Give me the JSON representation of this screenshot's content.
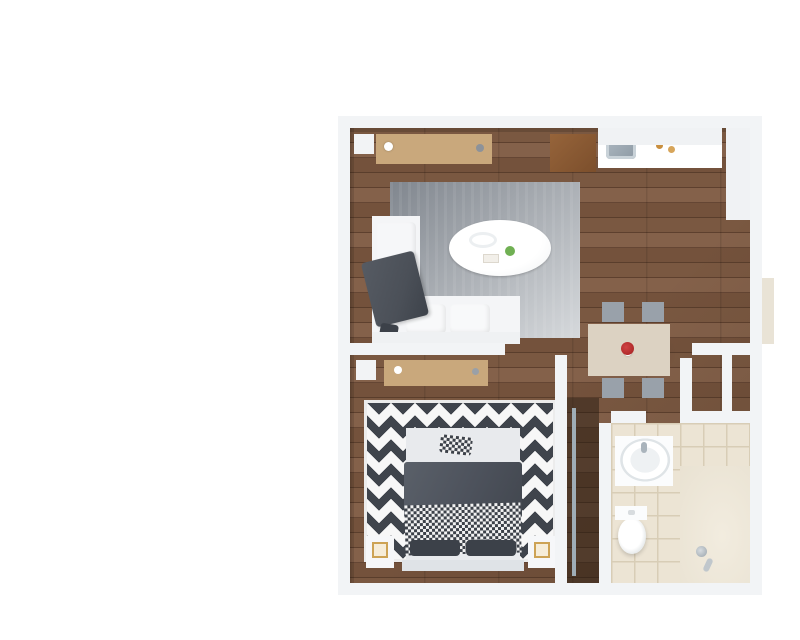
{
  "view": {
    "style": "3d-isometric-floorplan-render",
    "background": "#ffffff",
    "unit_type": "one-bedroom-apartment"
  },
  "palette": {
    "bg": "#ffffff",
    "walltop": "#f2f4f6",
    "wallin": "#e8ebee",
    "wallin2": "#e2e5e9",
    "wallpart": "#e6e9ec",
    "wallext": "#cdd3da",
    "wallext2": "#d6dbe1",
    "slab": "#c4cad1",
    "wood1": "#7a5841",
    "wood2": "#5e402e",
    "wood3": "#84614a",
    "wood4": "#654634",
    "tile": "#ece4d4",
    "tileline": "#d8cdb6",
    "shower": "#f2ecdf",
    "shade": "rgba(30,20,10,0.16)",
    "rug1": "#80868e",
    "rug2": "#d6d9dc",
    "chev": "#3f444c",
    "sofa": "#f4f5f7",
    "sofaside": "#e2e5e9",
    "sofadark": "#d4d8dd",
    "throw": "#4b5058",
    "duvet": "#4d525c",
    "mattress": "#e8eaed",
    "headboard": "#dfe3e7",
    "pillow": "#3c4149",
    "woodtop": "#c9a87c",
    "woodside": "#b08e60",
    "confront": "#f4f5f7",
    "slat": "#a9afb7",
    "granite": "#d8c7a2",
    "cabinet": "#edeff1",
    "cabinet2": "#e4e7ea",
    "cabside": "#d9dde1",
    "steel": "#c3c9ce",
    "browntop": "#8a5a33",
    "door": "#f6f8fa",
    "glass": "rgba(187,208,220,0.32)",
    "rail": "#9fadb6",
    "tabletop": "#dcd2c2",
    "tableside": "#cfc4b0",
    "chairseat": "#99a1aa",
    "chairframe": "#eef0f2",
    "green1": "#3e7d2f",
    "green2": "#70b053",
    "lamp": "#f6edd9",
    "gold": "#cda355",
    "flower": "#b02a2a",
    "tv1": "#cfe3ef",
    "tv2": "#8fb4cc",
    "tv3": "#44719c",
    "tv4": "#1e3c57",
    "cl1": "#e84a8f",
    "cl2": "#f7c948",
    "cl3": "#8bd04e",
    "cl4": "#2ec4b6",
    "cl5": "#f2994a",
    "cl6": "#c0392b"
  },
  "rooms": [
    {
      "name": "living-room",
      "items": [
        "sectional-sofa",
        "chaise",
        "throw-blanket",
        "coffee-table",
        "area-rug",
        "tv-console",
        "television",
        "floor-plant",
        "decor-bowl"
      ]
    },
    {
      "name": "kitchen",
      "items": [
        "base-cabinets",
        "granite-countertop",
        "sink",
        "canisters",
        "upper-cabinets",
        "tall-cabinet",
        "appliance",
        "storage-cabinet",
        "bifold-door"
      ]
    },
    {
      "name": "dining-area",
      "items": [
        "dining-table",
        "dining-chairs",
        "red-flower-centerpiece"
      ]
    },
    {
      "name": "bedroom",
      "items": [
        "double-bed",
        "headboard",
        "duvet",
        "checkered-throw",
        "pillows",
        "chevron-rug",
        "nightstands",
        "cube-lamps",
        "tv-console",
        "television",
        "floor-plant"
      ]
    },
    {
      "name": "walk-through-closet",
      "items": [
        "hanging-clothes",
        "closet-rail"
      ]
    },
    {
      "name": "bathroom",
      "items": [
        "vanity-sink",
        "faucet",
        "toilet",
        "tile-floor",
        "glass-shower-partition",
        "shower-head"
      ]
    },
    {
      "name": "entry-hall",
      "items": [
        "entry-door",
        "entry-step",
        "closet-partitions"
      ]
    }
  ],
  "counts": {
    "living_windows": 3,
    "bedroom_windows": 3,
    "dining_chairs": 4,
    "nightstands": 2,
    "table_lamps": 2,
    "televisions": 2,
    "floor_plants": 2,
    "interior_doors": 3,
    "entry_doors": 1
  }
}
